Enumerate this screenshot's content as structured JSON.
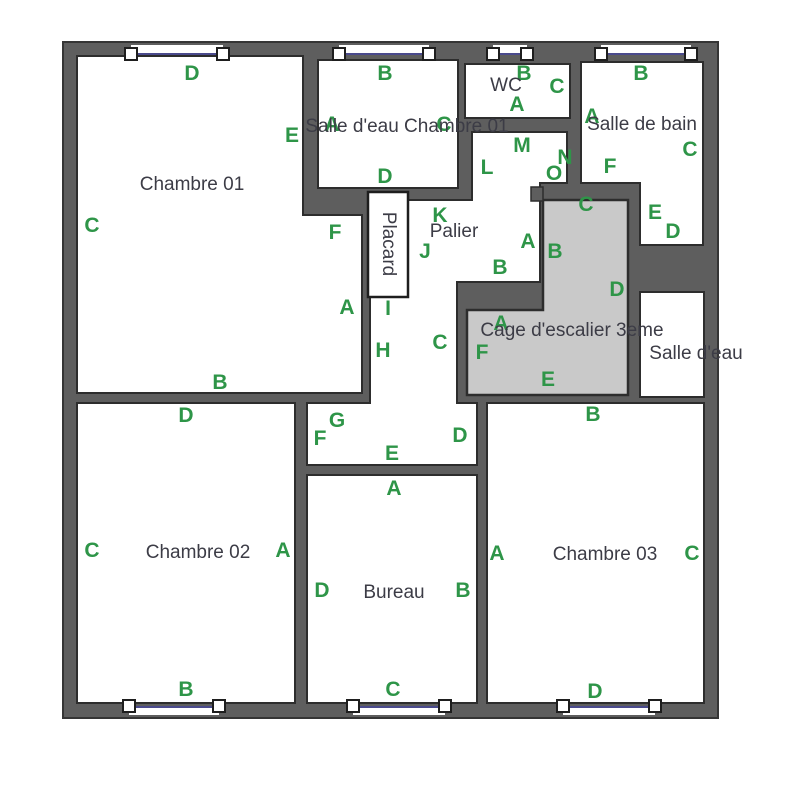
{
  "plan": {
    "type": "floor-plan",
    "colors": {
      "wall": "#5e5e5e",
      "room_fill": "#ffffff",
      "stairwell_fill": "#c9c9c9",
      "marker_green": "#2e9548",
      "room_text": "#3c3c46",
      "window_line": "#4a4a8c"
    }
  },
  "rooms": {
    "chambre01": {
      "name": "Chambre 01"
    },
    "salle_eau_ch01": {
      "name": "Salle d'eau Chambre 01"
    },
    "wc": {
      "name": "WC"
    },
    "salle_de_bain": {
      "name": "Salle de bain"
    },
    "palier": {
      "name": "Palier"
    },
    "placard": {
      "name": "Placard"
    },
    "cage": {
      "name": "Cage d'escalier 3eme"
    },
    "salle_eau": {
      "name": "Salle d'eau"
    },
    "chambre02": {
      "name": "Chambre 02"
    },
    "bureau": {
      "name": "Bureau"
    },
    "chambre03": {
      "name": "Chambre 03"
    }
  },
  "markers": [
    {
      "letter": "D"
    },
    {
      "letter": "C"
    },
    {
      "letter": "B"
    },
    {
      "letter": "E"
    },
    {
      "letter": "F"
    },
    {
      "letter": "A"
    },
    {
      "letter": "B"
    },
    {
      "letter": "A"
    },
    {
      "letter": "C"
    },
    {
      "letter": "D"
    },
    {
      "letter": "B"
    },
    {
      "letter": "C"
    },
    {
      "letter": "A"
    },
    {
      "letter": "B"
    },
    {
      "letter": "A"
    },
    {
      "letter": "C"
    },
    {
      "letter": "F"
    },
    {
      "letter": "E"
    },
    {
      "letter": "D"
    },
    {
      "letter": "M"
    },
    {
      "letter": "L"
    },
    {
      "letter": "N"
    },
    {
      "letter": "O"
    },
    {
      "letter": "K"
    },
    {
      "letter": "J"
    },
    {
      "letter": "A"
    },
    {
      "letter": "B"
    },
    {
      "letter": "C"
    },
    {
      "letter": "B"
    },
    {
      "letter": "D"
    },
    {
      "letter": "A"
    },
    {
      "letter": "F"
    },
    {
      "letter": "E"
    },
    {
      "letter": "I"
    },
    {
      "letter": "H"
    },
    {
      "letter": "C"
    },
    {
      "letter": "G"
    },
    {
      "letter": "F"
    },
    {
      "letter": "E"
    },
    {
      "letter": "D"
    },
    {
      "letter": "B"
    },
    {
      "letter": "D"
    },
    {
      "letter": "C"
    },
    {
      "letter": "A"
    },
    {
      "letter": "B"
    },
    {
      "letter": "A"
    },
    {
      "letter": "D"
    },
    {
      "letter": "B"
    },
    {
      "letter": "C"
    },
    {
      "letter": "A"
    },
    {
      "letter": "C"
    },
    {
      "letter": "D"
    }
  ]
}
